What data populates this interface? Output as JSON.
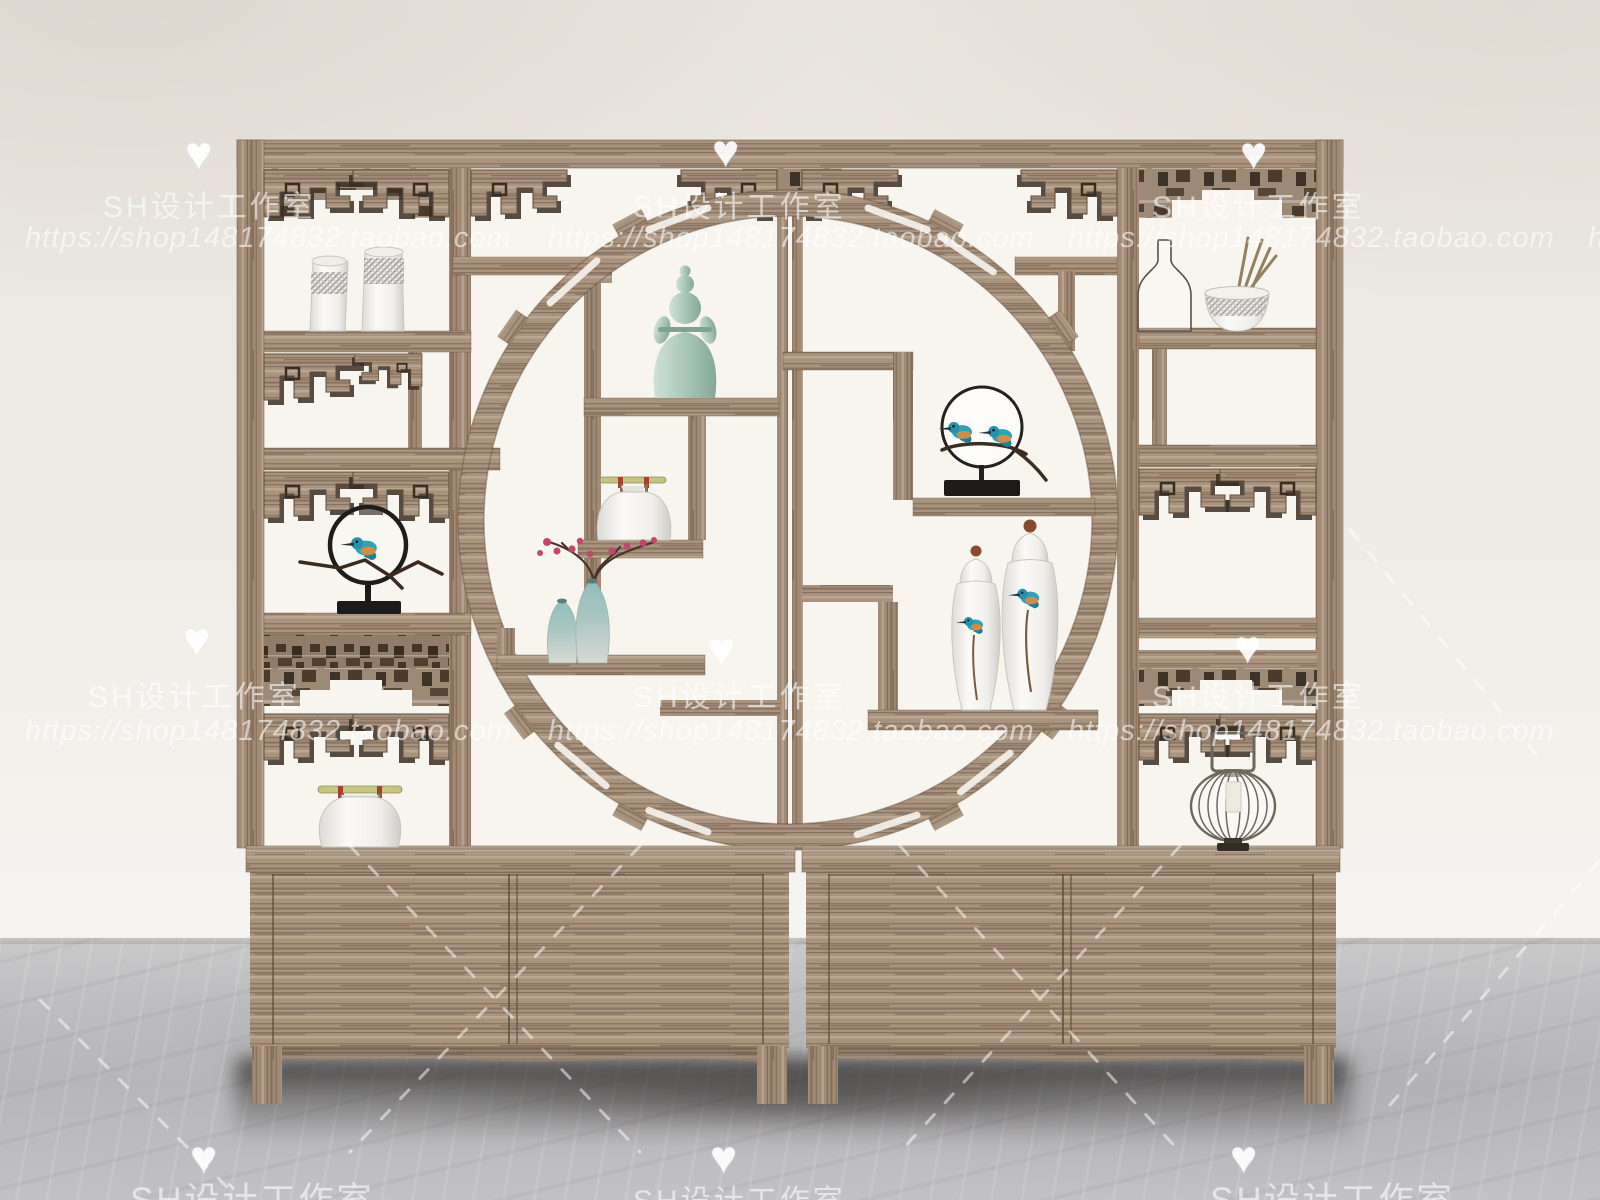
{
  "watermark": {
    "studio": "SH设计工作室",
    "url": "https://shop148174832.taobao.com",
    "heart": "♥"
  },
  "scene": {
    "type": "3d-furniture-product-render",
    "subject": "Chinese duobaoge antique display shelf with round moon-gate opening, fretwork lattice corners and two-door cabinet base, standing on a marble floor",
    "palette": {
      "wood": "#a8937e",
      "wood_dark": "#6b5640",
      "fret_shadow": "#3a2e22",
      "backdrop_white": "#f8f5ee",
      "wall": "#edeae3",
      "floor": "#bdbcbe",
      "porcelain": "#f3f2ef",
      "celadon": "#a9c7b8",
      "kingfisher_teal": "#2ba3bd",
      "kingfisher_orange": "#d78a42",
      "plum_pink": "#c2486b",
      "stand_black": "#1d1b19",
      "bamboo": "#c6c483",
      "lantern_wire": "#6e675c"
    }
  },
  "display_items": [
    {
      "name": "pair of white vases with plaid band",
      "location": "top-left compartment"
    },
    {
      "name": "celadon lady figurine",
      "location": "upper center, inside moon gate"
    },
    {
      "name": "glass bottle and bowl with chopsticks",
      "location": "top-right compartment"
    },
    {
      "name": "kingfisher-in-ring sculpture on black base",
      "location": "middle-left compartment"
    },
    {
      "name": "white jar with bamboo handle",
      "location": "center-left inside moon gate"
    },
    {
      "name": "plum blossom branch with two celadon gradient vases",
      "location": "lower-left inside moon gate"
    },
    {
      "name": "two kingfishers on branch sculpture",
      "location": "center-right inside moon gate"
    },
    {
      "name": "pair of tall kingfisher-painted porcelain vases",
      "location": "lower-right inside moon gate"
    },
    {
      "name": "white teapot with bamboo handle",
      "location": "bottom-left compartment"
    },
    {
      "name": "wire cage candle lantern",
      "location": "bottom-right compartment"
    }
  ]
}
